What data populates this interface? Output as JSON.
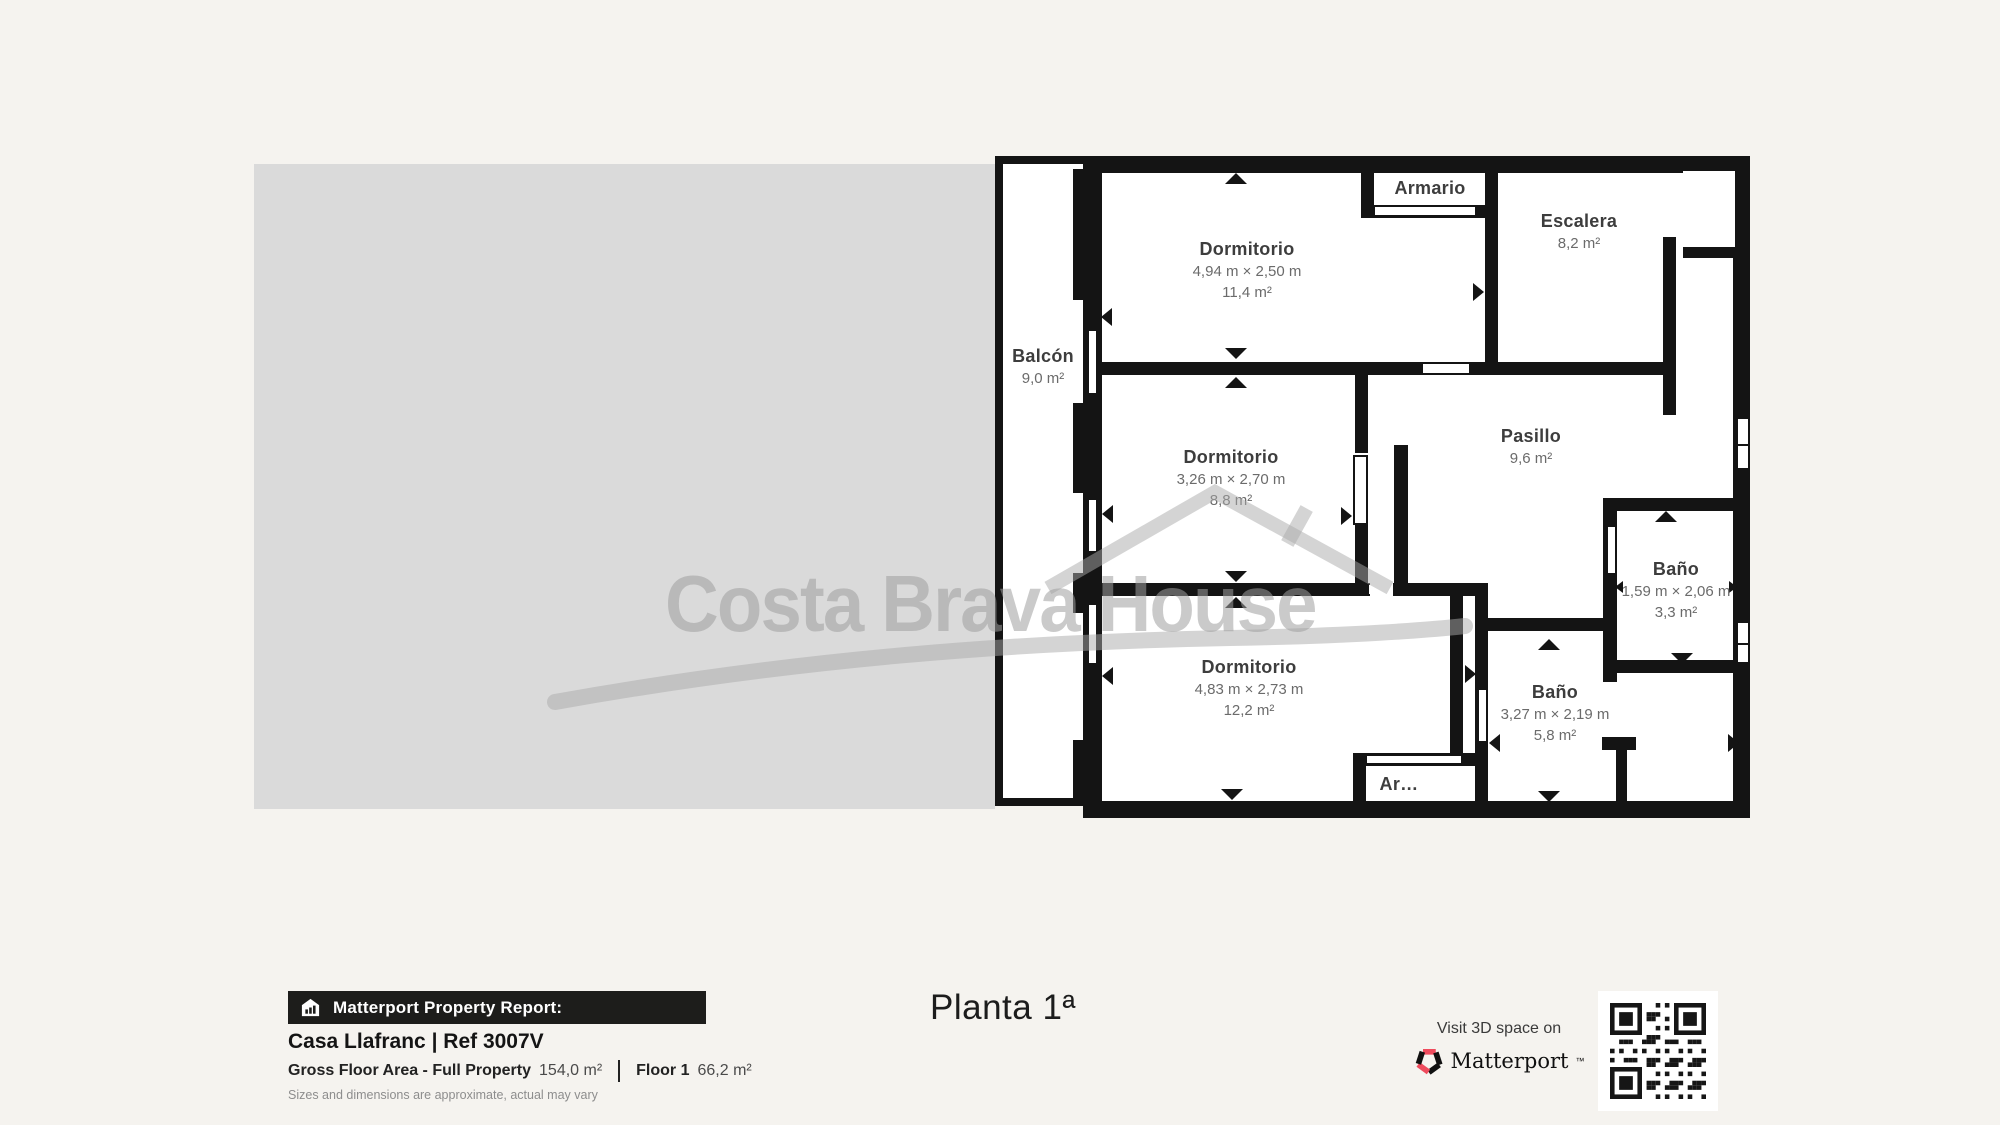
{
  "watermark": {
    "brand": "Costa Brava House"
  },
  "plan": {
    "title": "Planta 1ª",
    "rooms": [
      {
        "id": "balcon",
        "name": "Balcón",
        "area": "9,0 m²"
      },
      {
        "id": "dormitorio-1",
        "name": "Dormitorio",
        "dims": "4,94 m × 2,50 m",
        "area": "11,4 m²"
      },
      {
        "id": "armario",
        "name": "Armario"
      },
      {
        "id": "escalera",
        "name": "Escalera",
        "area": "8,2 m²"
      },
      {
        "id": "dormitorio-2",
        "name": "Dormitorio",
        "dims": "3,26 m × 2,70 m",
        "area": "8,8 m²"
      },
      {
        "id": "pasillo",
        "name": "Pasillo",
        "area": "9,6 m²"
      },
      {
        "id": "bano-1",
        "name": "Baño",
        "dims": "1,59 m × 2,06 m",
        "area": "3,3 m²"
      },
      {
        "id": "dormitorio-3",
        "name": "Dormitorio",
        "dims": "4,83 m × 2,73 m",
        "area": "12,2 m²"
      },
      {
        "id": "bano-2",
        "name": "Baño",
        "dims": "3,27 m × 2,19 m",
        "area": "5,8 m²"
      },
      {
        "id": "armario-2",
        "name": "Ar…"
      }
    ]
  },
  "report": {
    "badge": "Matterport Property Report:",
    "property_title": "Casa Llafranc | Ref 3007V",
    "gfa_label": "Gross Floor Area - Full Property",
    "gfa_value": "154,0 m²",
    "floor_label": "Floor 1",
    "floor_value": "66,2 m²",
    "disclaimer": "Sizes and dimensions are approximate, actual may vary"
  },
  "cta": {
    "visit_text": "Visit 3D space on",
    "brand": "Matterport",
    "brand_mark": "™"
  },
  "colors": {
    "wall": "#141414",
    "accent_red": "#ef4b5d",
    "page_bg": "#f5f3ef",
    "panel_gray": "#dadada"
  }
}
